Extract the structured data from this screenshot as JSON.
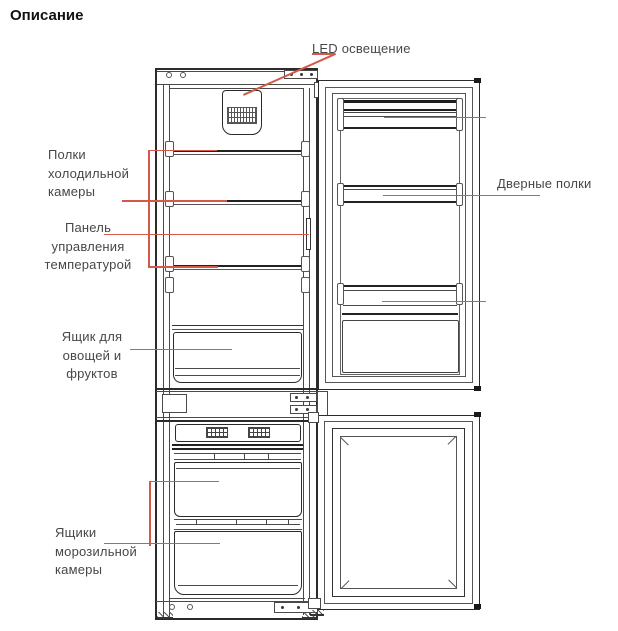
{
  "page": {
    "title": "Описание"
  },
  "diagram": {
    "type": "refrigerator-parts-diagram",
    "callouts": [
      {
        "id": "led-light",
        "label": "LED освещение"
      },
      {
        "id": "fridge-shelves",
        "label": "Полки\nхолодильной\nкамеры"
      },
      {
        "id": "temp-control",
        "label": "Панель\nуправления\nтемпературой"
      },
      {
        "id": "crisper-drawer",
        "label": "Ящик для\nовощей и\nфруктов"
      },
      {
        "id": "freezer-drawers",
        "label": "Ящики\nморозильной\nкамеры"
      },
      {
        "id": "door-shelves",
        "label": "Дверные полки"
      }
    ],
    "colors": {
      "leader_line": "#d15a4b",
      "label_text": "#474747",
      "line_art": "#4a4a4a",
      "line_dark": "#2b2b2b"
    }
  }
}
